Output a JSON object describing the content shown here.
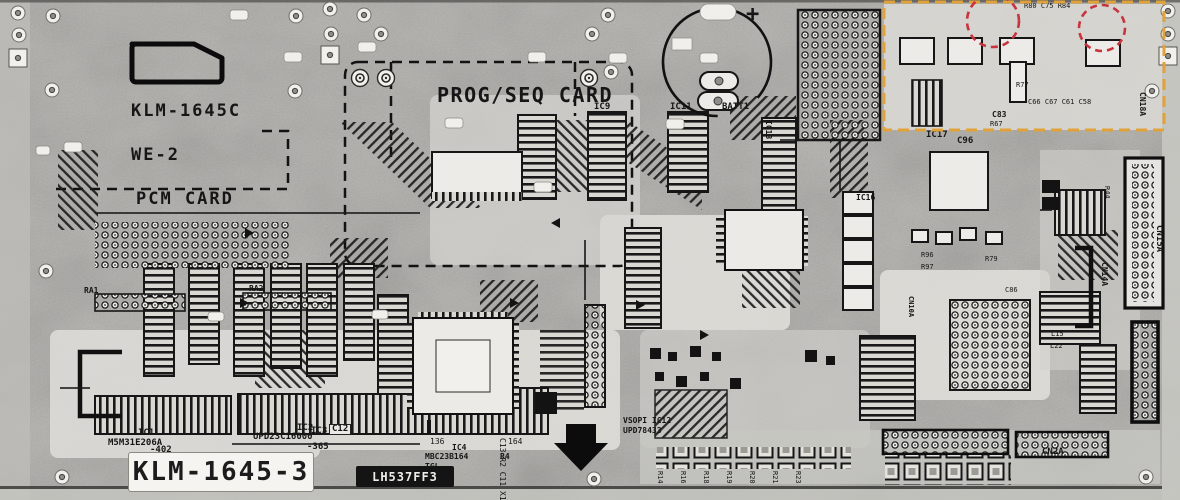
{
  "board": {
    "silkscreen": {
      "board_code": "KLM-1645C",
      "board_rev": "WE-2",
      "pcm_card": "PCM CARD",
      "prog_seq_card": "PROG/SEQ CARD",
      "board_id_label": "KLM-1645-3",
      "ic_sticker": "LH537FF3",
      "battery_plus": "+"
    },
    "components": {
      "ic1_ref": "IC1",
      "ic1_part": "M5M31E206A",
      "ic1_code": "-402",
      "ic2_ref": "IC2",
      "ic2_part": "UPD23C16000",
      "ic2_code": "-365",
      "ic3_ref": "IC3",
      "c12_ref": "C12",
      "ic4_ref": "IC4",
      "ic4_part": "MBC23B164",
      "ic4_code": "TGL",
      "ic4_pin_a": "136",
      "ic4_pin_b": "164",
      "r4_ref": "R4",
      "ic9_ref": "IC9",
      "ic11_ref": "IC11",
      "batt_ref": "BATT1",
      "ic13_ref": "IC13",
      "ic16_ref": "IC16",
      "ic17_ref": "IC17",
      "ic12_pkg": "VSOPI IC12",
      "ic12_part": "UPD78433",
      "c96_ref": "C96",
      "ra1_ref": "RA1",
      "ra2_ref": "RA2",
      "r44_ref": "R44",
      "r96_ref": "R96",
      "r97_ref": "R97",
      "r79_ref": "R79",
      "c86_ref": "C86",
      "l15_ref": "L15",
      "l22_ref": "L22",
      "r80_row": "R80 C75 R84",
      "r77_ref": "R77",
      "c83_ref": "C83",
      "r67_ref": "R67",
      "cap_row": "C66 C67 C61 C58",
      "side_row": "C13 R2 C11 X1"
    },
    "connectors": {
      "cn2a": "CN2A",
      "cn15a": "CN15A",
      "cn14a": "CN14A",
      "cn10a": "CN10A",
      "cn18a": "CN18A"
    },
    "ref_labels": [
      "R14",
      "R16",
      "R18",
      "R19",
      "R20",
      "R21",
      "R23"
    ]
  },
  "annotations": {
    "box_color": "#E2A23A",
    "circle_color": "#C8333E"
  }
}
